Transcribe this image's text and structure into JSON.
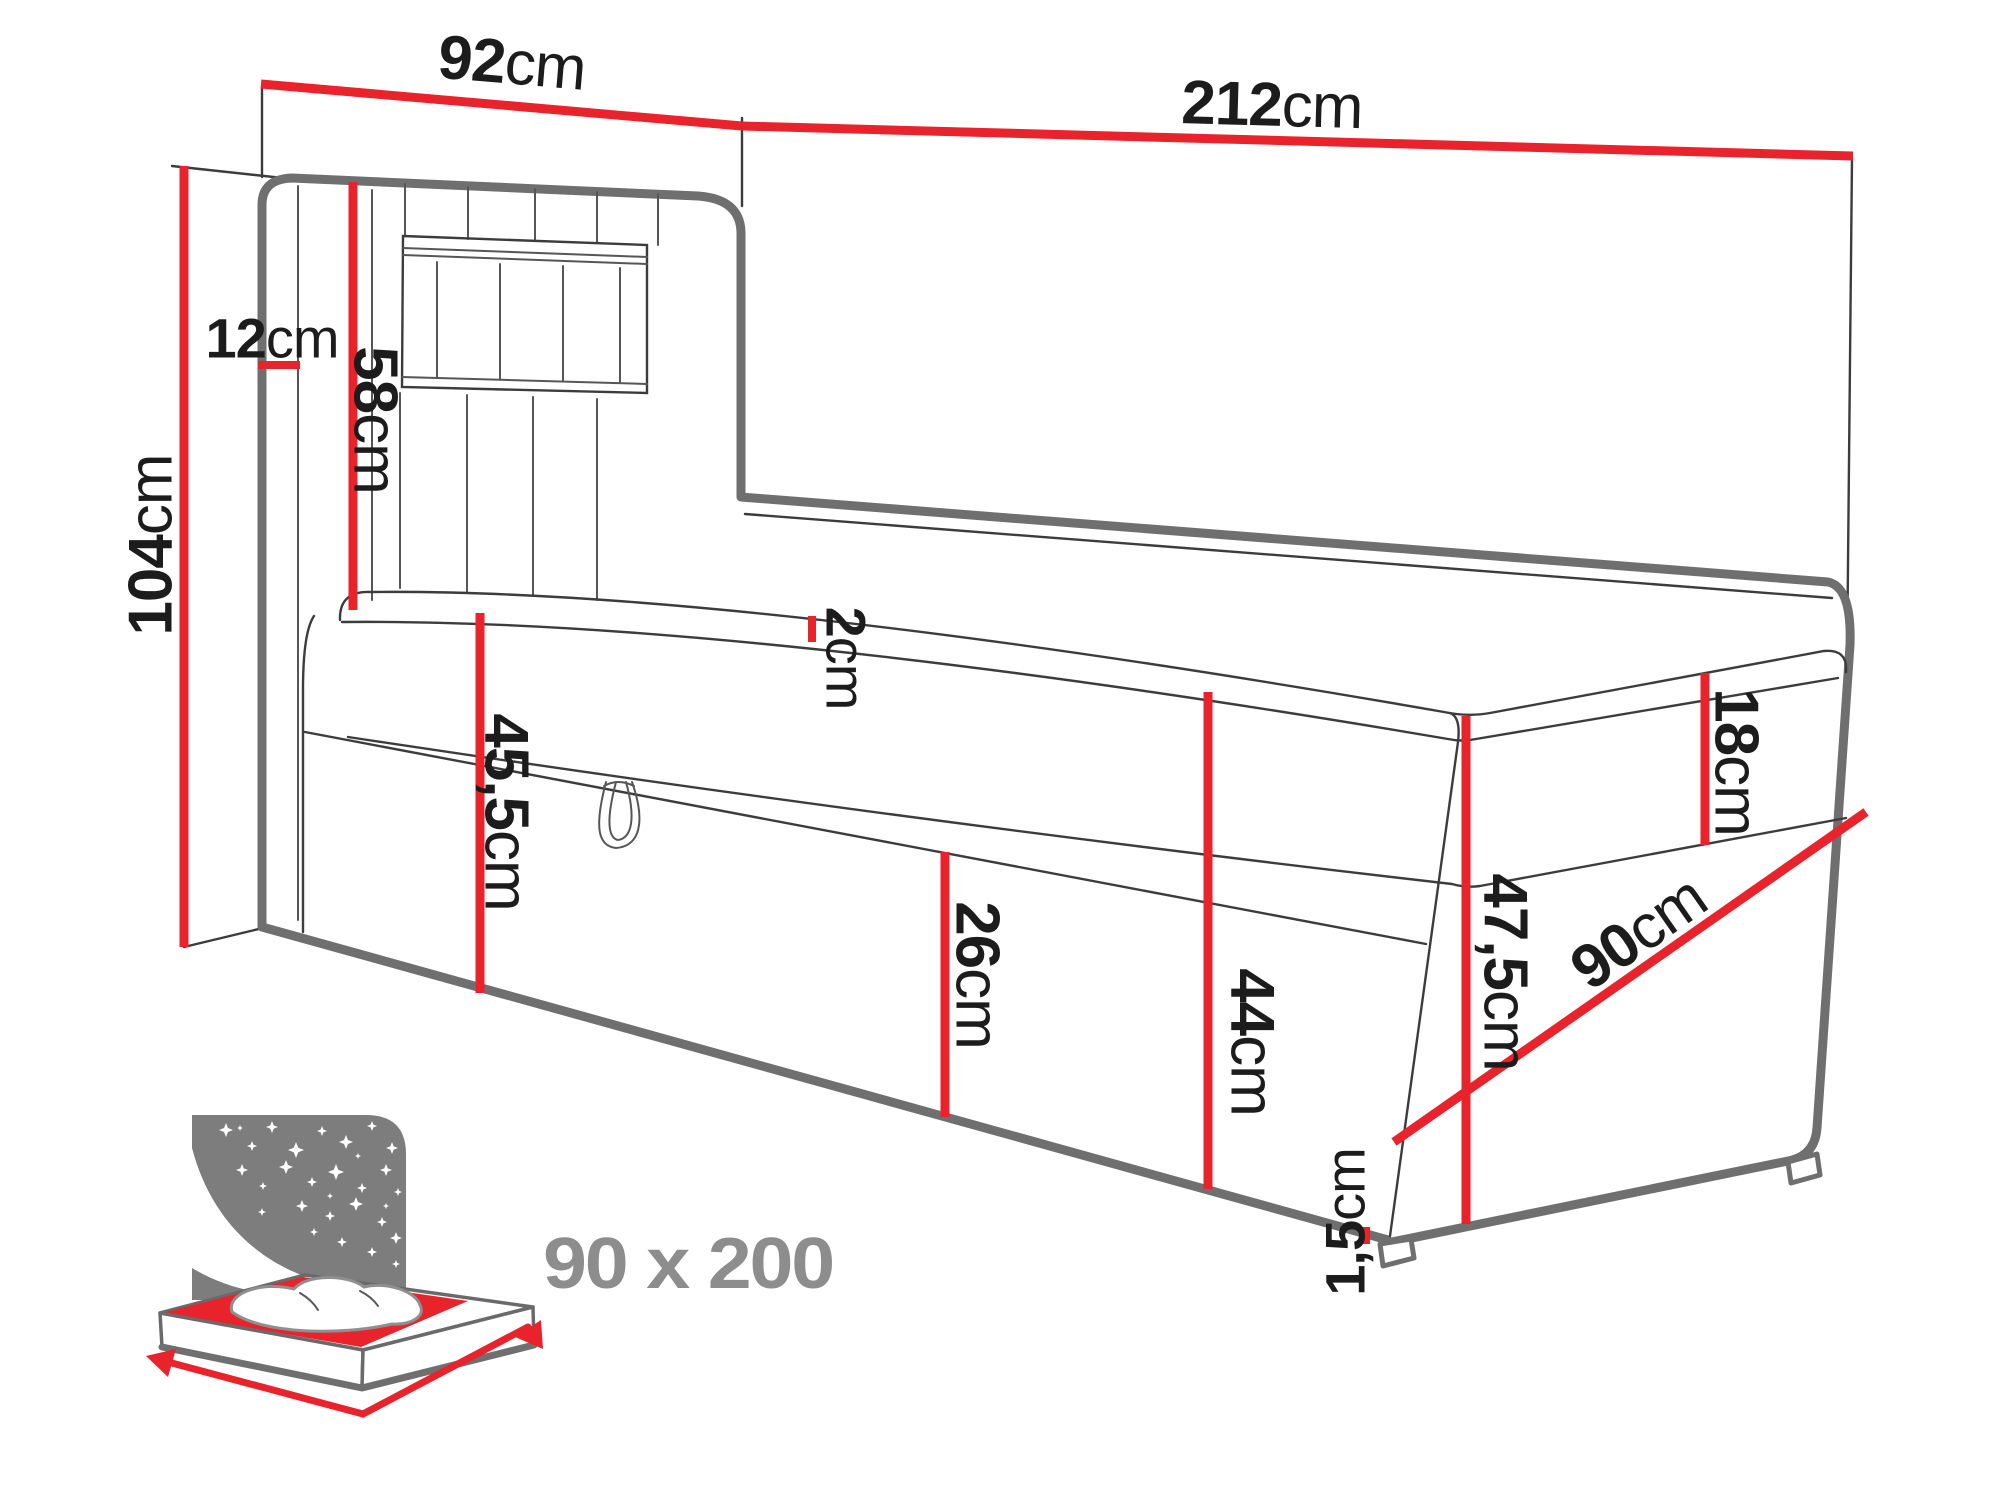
{
  "title": "Boxspring bed dimension diagram",
  "dimensions": {
    "headboard_width": {
      "num": "92",
      "unit": "cm"
    },
    "total_length": {
      "num": "212",
      "unit": "cm"
    },
    "total_height": {
      "num": "104",
      "unit": "cm"
    },
    "headboard_depth": {
      "num": "12",
      "unit": "cm"
    },
    "headboard_above_mattress": {
      "num": "58",
      "unit": "cm"
    },
    "topper_thickness": {
      "num": "2",
      "unit": "cm"
    },
    "base_height": {
      "num": "45,5",
      "unit": "cm"
    },
    "drawer_height": {
      "num": "26",
      "unit": "cm"
    },
    "side_height": {
      "num": "44",
      "unit": "cm"
    },
    "mattress_thickness": {
      "num": "18",
      "unit": "cm"
    },
    "foot_total_height": {
      "num": "47,5",
      "unit": "cm"
    },
    "bed_width": {
      "num": "90",
      "unit": "cm"
    },
    "leg_height": {
      "num": "1,5",
      "unit": "cm"
    }
  },
  "badge": {
    "size": "90 x 200"
  },
  "colors": {
    "dimension_red": "#e8232b",
    "outline_gray": "#6f6f6f",
    "icon_gray": "#7d7d7d",
    "badge_gray": "#8d8d8d",
    "label_black": "#1c1c1c"
  }
}
